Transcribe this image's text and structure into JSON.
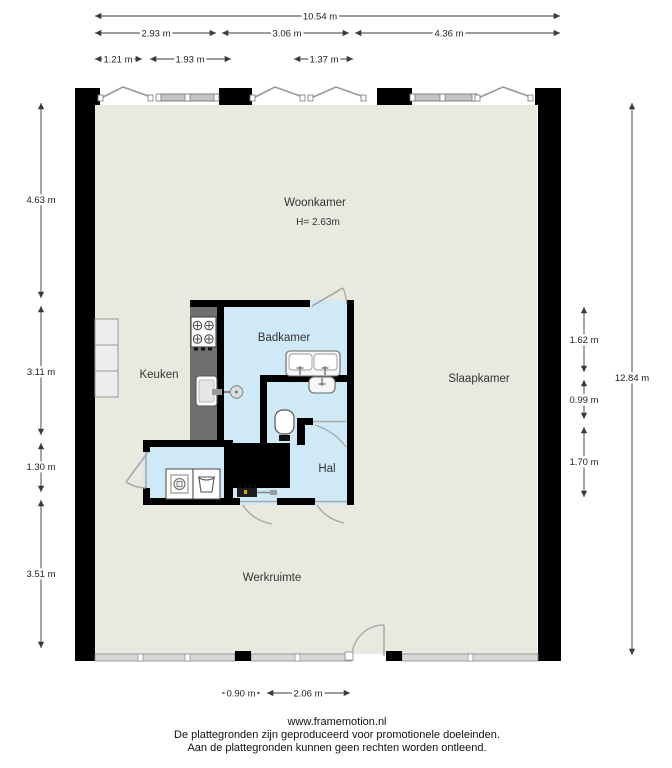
{
  "rooms": {
    "woonkamer": {
      "label": "Woonkamer",
      "height": "H= 2.63m"
    },
    "keuken": {
      "label": "Keuken"
    },
    "badkamer": {
      "label": "Badkamer"
    },
    "slaapkamer": {
      "label": "Slaapkamer"
    },
    "hal": {
      "label": "Hal"
    },
    "werkruimte": {
      "label": "Werkruimte"
    }
  },
  "dimensions": {
    "top_total": "10.54 m",
    "top_sections": [
      "2.93 m",
      "3.06 m",
      "4.36 m"
    ],
    "top_windows": [
      "1.21 m",
      "1.93 m",
      "1.37 m"
    ],
    "left": [
      "4.63 m",
      "3.11 m",
      "1.30 m",
      "3.51 m"
    ],
    "right_total": "12.84 m",
    "right_sections": [
      "1.62 m",
      "0.99 m",
      "1.70 m"
    ],
    "bottom": [
      "0.90 m",
      "2.06 m"
    ]
  },
  "footer": {
    "website": "www.framemotion.nl",
    "disclaimer1": "De plattegronden zijn geproduceerd voor promotionele doeleinden.",
    "disclaimer2": "Aan de plattegronden kunnen geen rechten worden ontleend."
  },
  "fixtures": [
    "stove",
    "kitchen-sink",
    "shower",
    "double-washbasin",
    "washbasin",
    "toilet",
    "washing-machine",
    "laundry-basket",
    "meter-box",
    "kitchen-cabinet"
  ],
  "colors": {
    "floor": "#eae9e0",
    "wet_room": "#cfe9f7",
    "wall": "#000000",
    "counter": "#6f6f6f",
    "symbol_gray": "#a9a9a9"
  }
}
